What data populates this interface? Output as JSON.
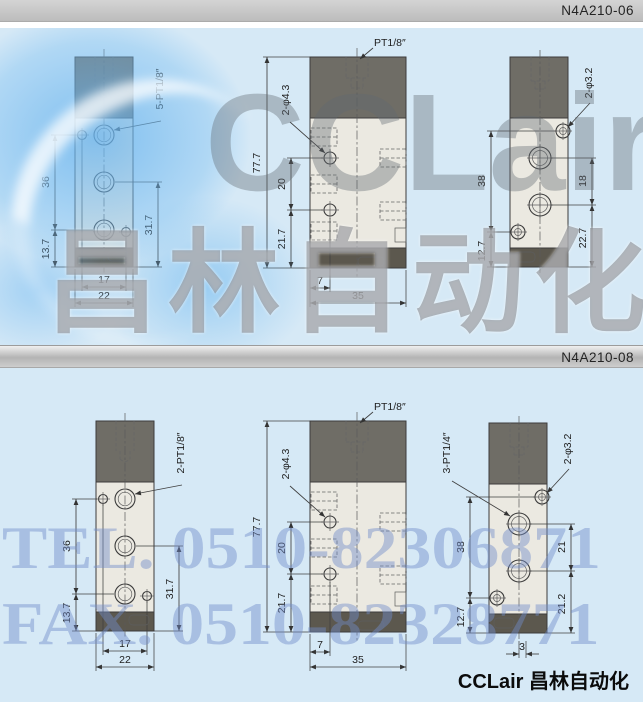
{
  "colors": {
    "panel_bg": "#d6e9f6",
    "bar_bg": "#c3c3c3",
    "body_dark": "#6f6d66",
    "body_light": "#ebe9e1",
    "body_band": "#5c584e",
    "line": "#3c3c3c",
    "watermark_gray": "#7d828a",
    "watermark_blue": "#708cc9",
    "swirl_blue": "#7fc0ee"
  },
  "brand": {
    "footer_text": "CCLair 昌林自动化",
    "watermark_latin": "CCLair",
    "watermark_cn": "昌林自动化",
    "watermark_tel": "TEL. 0510-82306871",
    "watermark_fax": "FAX. 0510-82328771"
  },
  "sections": [
    {
      "model": "N4A210-06",
      "front": {
        "port_label": "5-PT1/8″",
        "dim_left_top": "36",
        "dim_left_bottom": "13.7",
        "dim_right": "31.7",
        "dim_bottom_inner": "17",
        "dim_bottom_outer": "22"
      },
      "side": {
        "top_label": "PT1/8″",
        "hole_label": "2-φ4.3",
        "dim_height": "77.7",
        "dim_mid": "20",
        "dim_low": "21.7",
        "dim_bottom_inner": "7",
        "dim_bottom_outer": "35"
      },
      "back": {
        "hole_label": "2-φ3.2",
        "dim_left_top": "38",
        "dim_left_bottom": "12.7",
        "dim_right_top": "18",
        "dim_right_bottom": "22.7"
      }
    },
    {
      "model": "N4A210-08",
      "front": {
        "port_label": "2-PT1/8″",
        "dim_left_top": "36",
        "dim_left_bottom": "13.7",
        "dim_right": "31.7",
        "dim_bottom_inner": "17",
        "dim_bottom_outer": "22"
      },
      "side": {
        "top_label": "PT1/8″",
        "hole_label": "2-φ4.3",
        "dim_height": "77.7",
        "dim_mid": "20",
        "dim_low": "21.7",
        "dim_bottom_inner": "7",
        "dim_bottom_outer": "35"
      },
      "back": {
        "hole_label": "2-φ3.2",
        "port_label": "3-PT1/4″",
        "dim_left_top": "38",
        "dim_left_bottom": "12.7",
        "dim_right_top": "21",
        "dim_right_bottom": "21.2",
        "dim_bottom": "3"
      }
    }
  ]
}
